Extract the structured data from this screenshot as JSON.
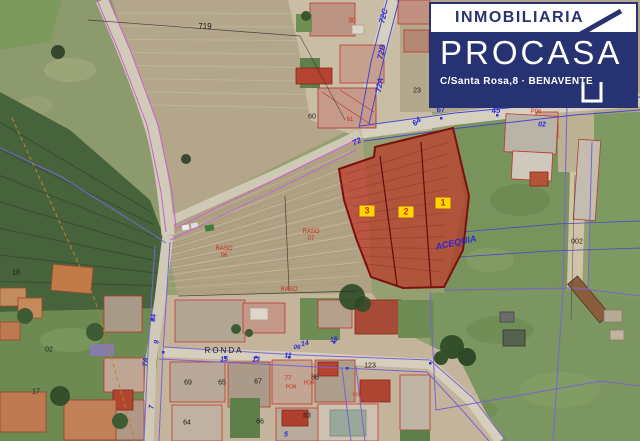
{
  "logo": {
    "line1": "INMOBILIARIA",
    "name": "PROCASA",
    "address": "C/Santa Rosa,8 · BENAVENTE",
    "navy": "#273272",
    "white": "#ffffff"
  },
  "parcels": {
    "numbers": [
      "1",
      "2",
      "3"
    ],
    "fill": "#c0392b",
    "stroke": "#7c100e",
    "badge_bg": "#ffd800",
    "badge_text": "#d42b00"
  },
  "palette": {
    "cadastral_magenta": "#c85fd0",
    "cadastral_purple": "#7a63d2",
    "cadastral_blue": "#4648cc",
    "road": "#d2cbba",
    "field_green": "#7e9a63",
    "field_brown": "#b3a487"
  },
  "map": {
    "labels": [
      {
        "text": "719",
        "x": 205,
        "y": 27,
        "cls": "blk",
        "size": 8
      },
      {
        "text": "30",
        "x": 352,
        "y": 21,
        "cls": "red",
        "size": 7
      },
      {
        "text": "72C",
        "x": 384,
        "y": 16,
        "cls": "blu",
        "size": 8,
        "rot": -76
      },
      {
        "text": "72B",
        "x": 382,
        "y": 52,
        "cls": "blu",
        "size": 8,
        "rot": -78
      },
      {
        "text": "72A",
        "x": 380,
        "y": 85,
        "cls": "blu",
        "size": 8,
        "rot": -80
      },
      {
        "text": "23",
        "x": 417,
        "y": 91,
        "cls": "blk",
        "size": 7
      },
      {
        "text": "60",
        "x": 312,
        "y": 117,
        "cls": "blk",
        "size": 7
      },
      {
        "text": "61",
        "x": 350,
        "y": 120,
        "cls": "red",
        "size": 6
      },
      {
        "text": "64",
        "x": 417,
        "y": 122,
        "cls": "blu",
        "size": 8,
        "rot": -40
      },
      {
        "text": "72",
        "x": 357,
        "y": 142,
        "cls": "blu",
        "size": 8,
        "rot": -25
      },
      {
        "text": "67",
        "x": 441,
        "y": 110,
        "cls": "blu",
        "size": 8,
        "rot": -7
      },
      {
        "text": "45",
        "x": 496,
        "y": 111,
        "cls": "blu",
        "size": 8,
        "rot": -7
      },
      {
        "text": "P06",
        "x": 536,
        "y": 112,
        "cls": "red",
        "size": 6
      },
      {
        "text": "02",
        "x": 542,
        "y": 125,
        "cls": "blu",
        "size": 7
      },
      {
        "text": "002",
        "x": 577,
        "y": 242,
        "cls": "blk",
        "size": 7
      },
      {
        "text": "3",
        "x": 367,
        "y": 211,
        "cls": "bdg",
        "size": 9
      },
      {
        "text": "2",
        "x": 406,
        "y": 212,
        "cls": "bdg",
        "size": 9
      },
      {
        "text": "1",
        "x": 443,
        "y": 203,
        "cls": "bdg",
        "size": 9
      },
      {
        "text": "ACEQUIA",
        "x": 456,
        "y": 243,
        "cls": "blu",
        "size": 9,
        "rot": -12
      },
      {
        "text": "RASO",
        "x": 224,
        "y": 249,
        "cls": "red",
        "size": 6
      },
      {
        "text": "06",
        "x": 224,
        "y": 256,
        "cls": "red",
        "size": 6
      },
      {
        "text": "RASO",
        "x": 311,
        "y": 232,
        "cls": "red",
        "size": 6
      },
      {
        "text": "07",
        "x": 311,
        "y": 239,
        "cls": "red",
        "size": 6
      },
      {
        "text": "RASO",
        "x": 289,
        "y": 290,
        "cls": "red",
        "size": 6
      },
      {
        "text": "18",
        "x": 16,
        "y": 273,
        "cls": "blk",
        "size": 7
      },
      {
        "text": "02",
        "x": 49,
        "y": 350,
        "cls": "blk",
        "size": 7
      },
      {
        "text": "17",
        "x": 36,
        "y": 392,
        "cls": "blk",
        "size": 7
      },
      {
        "text": "64",
        "x": 154,
        "y": 318,
        "cls": "blu",
        "size": 7,
        "rot": -85
      },
      {
        "text": "9",
        "x": 157,
        "y": 342,
        "cls": "blu",
        "size": 7,
        "rot": -85
      },
      {
        "text": "7A",
        "x": 146,
        "y": 362,
        "cls": "blu",
        "size": 7,
        "rot": -85
      },
      {
        "text": "7",
        "x": 152,
        "y": 407,
        "cls": "blu",
        "size": 7,
        "rot": -85
      },
      {
        "text": "RONDA",
        "x": 224,
        "y": 351,
        "cls": "street",
        "size": 8
      },
      {
        "text": "15",
        "x": 224,
        "y": 360,
        "cls": "blu",
        "size": 7
      },
      {
        "text": "13",
        "x": 256,
        "y": 360,
        "cls": "blu",
        "size": 7
      },
      {
        "text": "11",
        "x": 288,
        "y": 356,
        "cls": "blu",
        "size": 7
      },
      {
        "text": "06",
        "x": 297,
        "y": 348,
        "cls": "blu",
        "size": 6
      },
      {
        "text": "14",
        "x": 305,
        "y": 344,
        "cls": "blu",
        "size": 7,
        "rot": -10
      },
      {
        "text": "16",
        "x": 334,
        "y": 340,
        "cls": "blu",
        "size": 7,
        "rot": -10
      },
      {
        "text": "69",
        "x": 188,
        "y": 383,
        "cls": "blk",
        "size": 7
      },
      {
        "text": "65",
        "x": 222,
        "y": 383,
        "cls": "blk",
        "size": 7
      },
      {
        "text": "67",
        "x": 258,
        "y": 382,
        "cls": "blk",
        "size": 7
      },
      {
        "text": "77",
        "x": 288,
        "y": 379,
        "cls": "red",
        "size": 6
      },
      {
        "text": "86",
        "x": 315,
        "y": 378,
        "cls": "blk",
        "size": 7
      },
      {
        "text": "POR",
        "x": 291,
        "y": 388,
        "cls": "red",
        "size": 5
      },
      {
        "text": "POR",
        "x": 309,
        "y": 384,
        "cls": "red",
        "size": 5
      },
      {
        "text": "P06",
        "x": 357,
        "y": 396,
        "cls": "red",
        "size": 5
      },
      {
        "text": "64",
        "x": 187,
        "y": 423,
        "cls": "blk",
        "size": 7
      },
      {
        "text": "66",
        "x": 260,
        "y": 422,
        "cls": "blk",
        "size": 7
      },
      {
        "text": "83",
        "x": 307,
        "y": 416,
        "cls": "blk",
        "size": 7
      },
      {
        "text": "123",
        "x": 370,
        "y": 366,
        "cls": "blk",
        "size": 7
      },
      {
        "text": "5",
        "x": 286,
        "y": 435,
        "cls": "blu",
        "size": 7
      }
    ]
  }
}
